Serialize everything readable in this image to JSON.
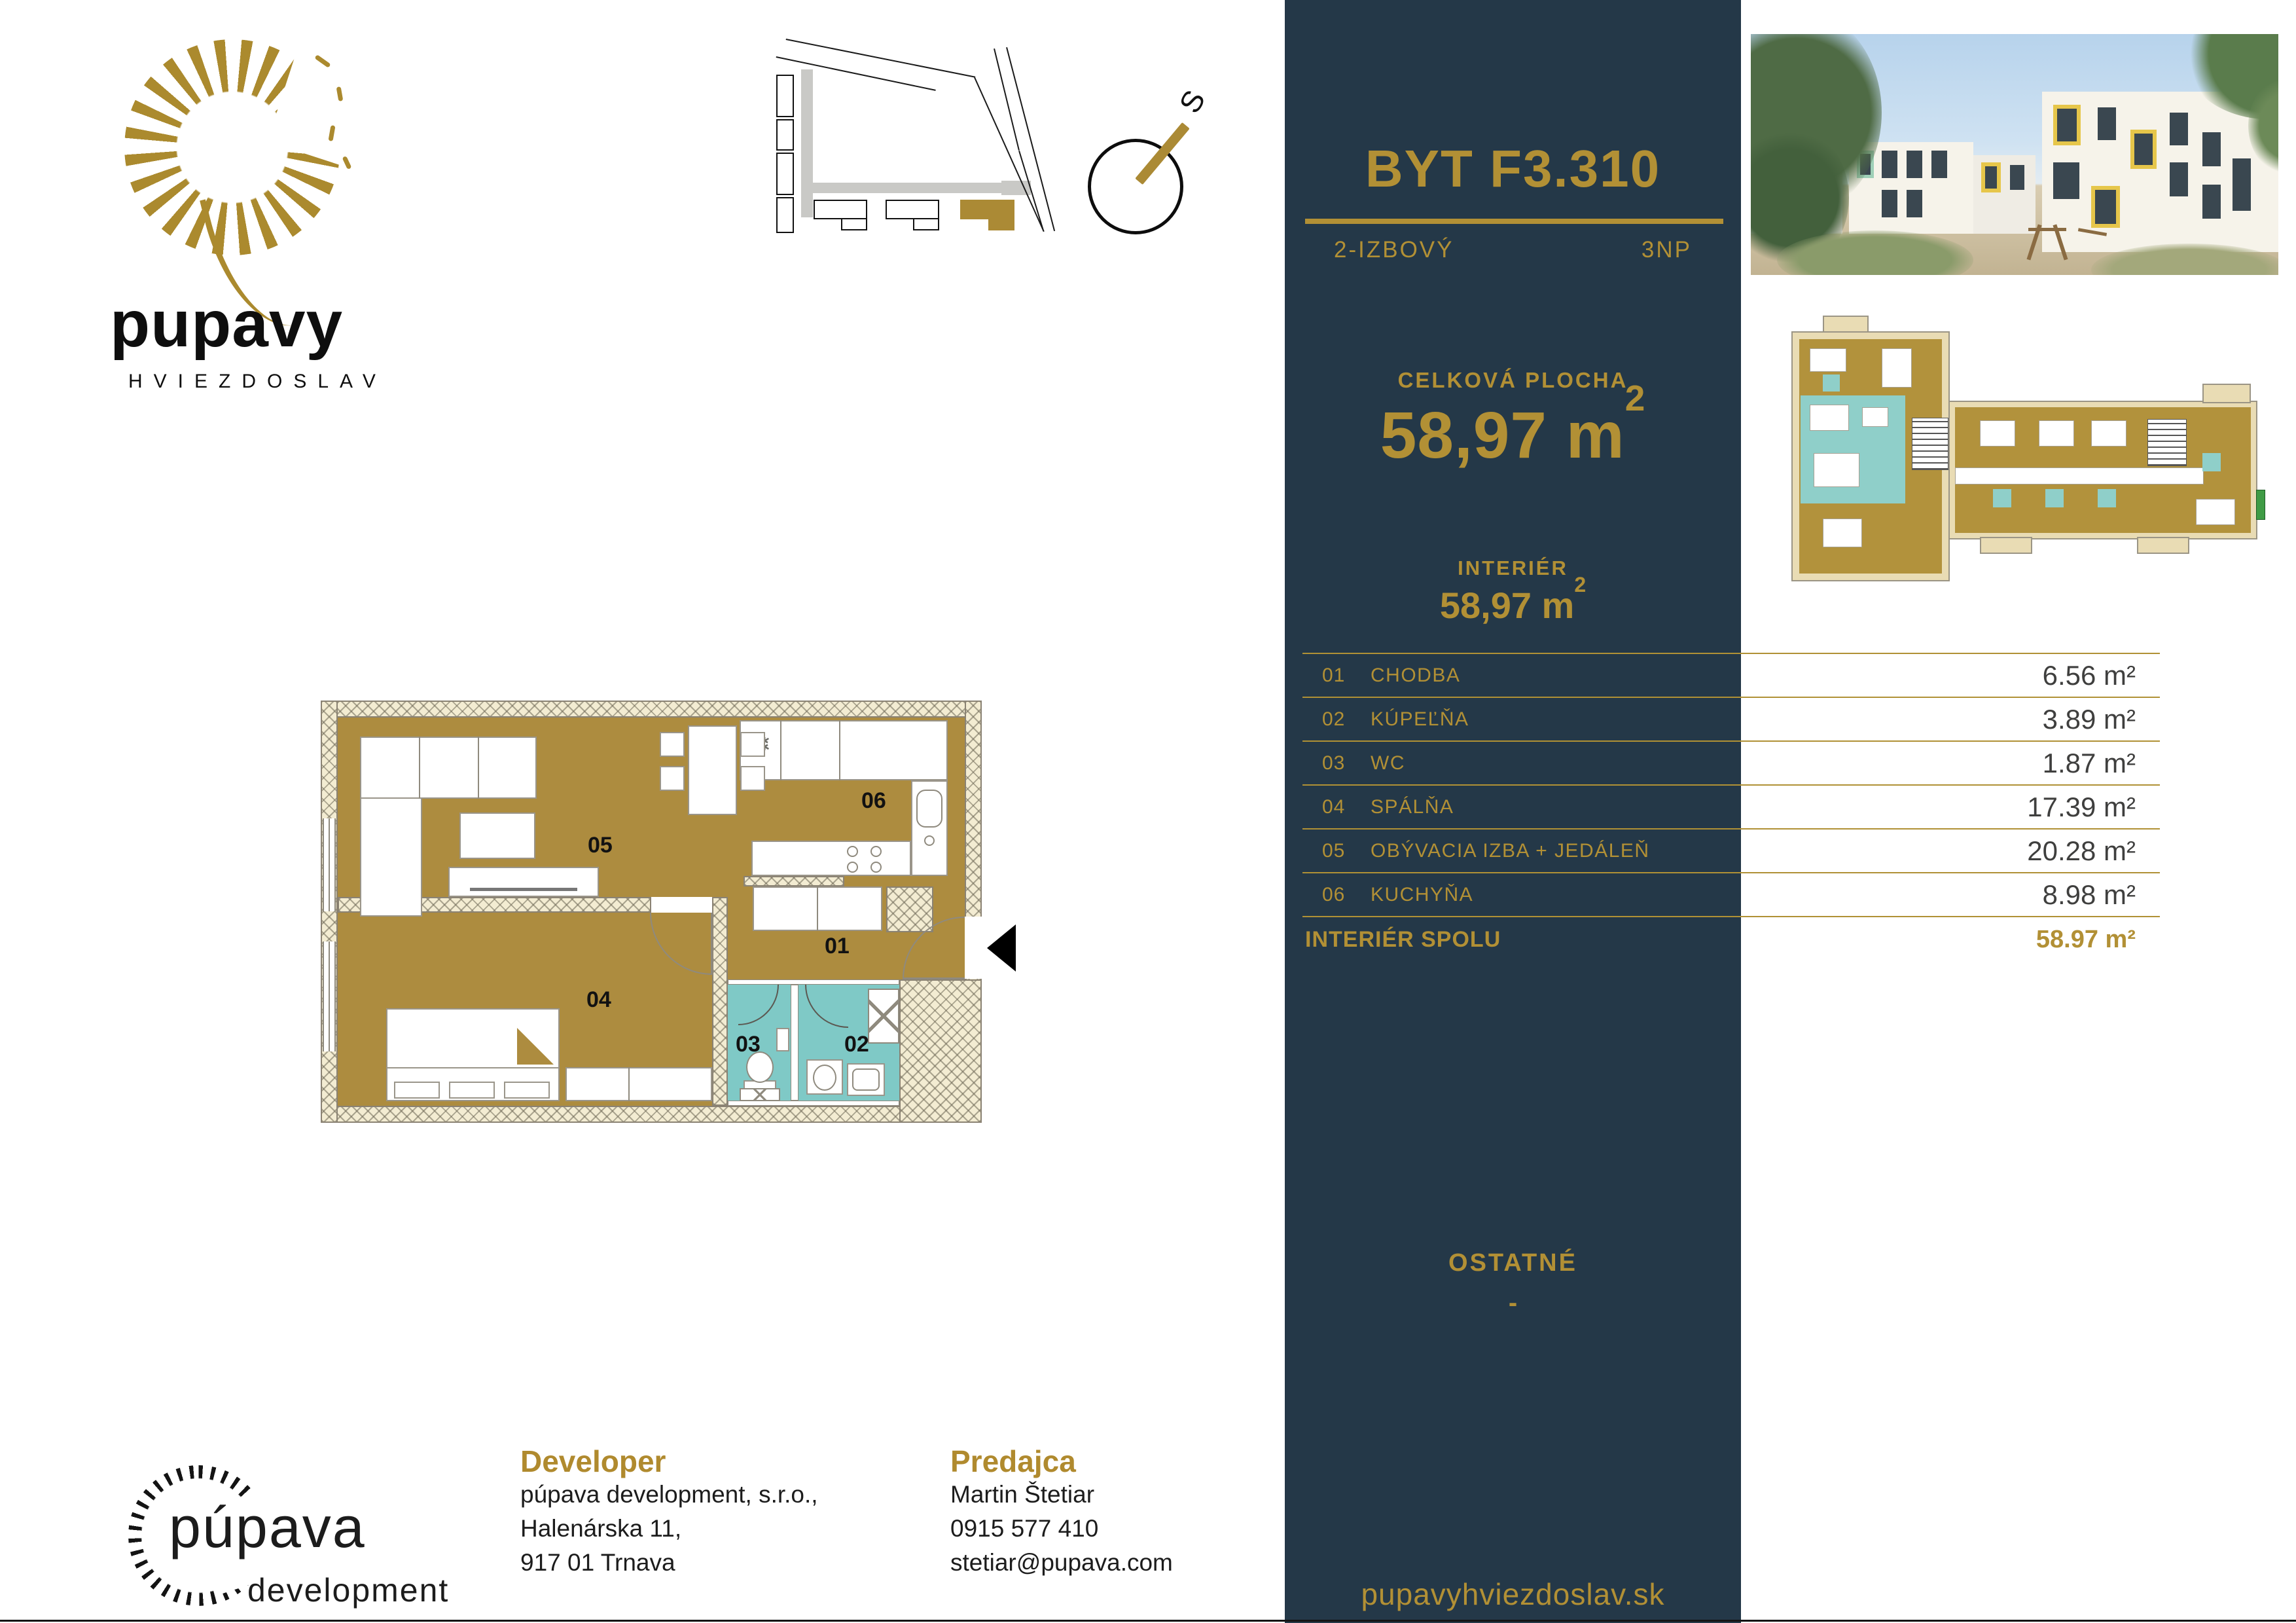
{
  "colors": {
    "accent": "#b29035",
    "navy": "#243848",
    "floor_gold": "#ad8c3f",
    "bath_teal": "#7fc9c6"
  },
  "brand": {
    "name": "pupavy",
    "subtitle": "HVIEZDOSLAV"
  },
  "compass": {
    "north": "S"
  },
  "unit": {
    "title": "BYT F3.310",
    "type": "2-IZBOVÝ",
    "floor": "3NP"
  },
  "summary": {
    "total_label": "CELKOVÁ PLOCHA",
    "total_value": "58,97",
    "total_unit": "m",
    "total_sup": "2",
    "interior_label": "INTERIÉR",
    "interior_value": "58,97",
    "interior_unit": "m",
    "interior_sup": "2"
  },
  "table": {
    "rows": [
      {
        "num": "01",
        "name": "CHODBA",
        "area": "6.56 m²"
      },
      {
        "num": "02",
        "name": "KÚPEĽŇA",
        "area": "3.89 m²"
      },
      {
        "num": "03",
        "name": "WC",
        "area": "1.87 m²"
      },
      {
        "num": "04",
        "name": "SPÁLŇA",
        "area": "17.39 m²"
      },
      {
        "num": "05",
        "name": "OBÝVACIA IZBA + JEDÁLEŇ",
        "area": "20.28 m²"
      },
      {
        "num": "06",
        "name": "KUCHYŇA",
        "area": "8.98 m²"
      }
    ],
    "total_label": "INTERIÉR SPOLU",
    "total_area": "58.97 m²"
  },
  "other": {
    "label": "OSTATNÉ",
    "value": "-"
  },
  "website": "pupavyhviezdoslav.sk",
  "developer": {
    "heading": "Developer",
    "lines": [
      "púpava development, s.r.o.,",
      "Halenárska 11,",
      "917 01 Trnava"
    ]
  },
  "seller": {
    "heading": "Predajca",
    "lines": [
      "Martin Štetiar",
      "0915 577 410",
      "stetiar@pupava.com"
    ]
  },
  "dev_logo": {
    "name": "púpava",
    "sub": "development"
  },
  "plan_labels": {
    "r1": "01",
    "r2": "02",
    "r3": "03",
    "r4": "04",
    "r5": "05",
    "r6": "06"
  }
}
